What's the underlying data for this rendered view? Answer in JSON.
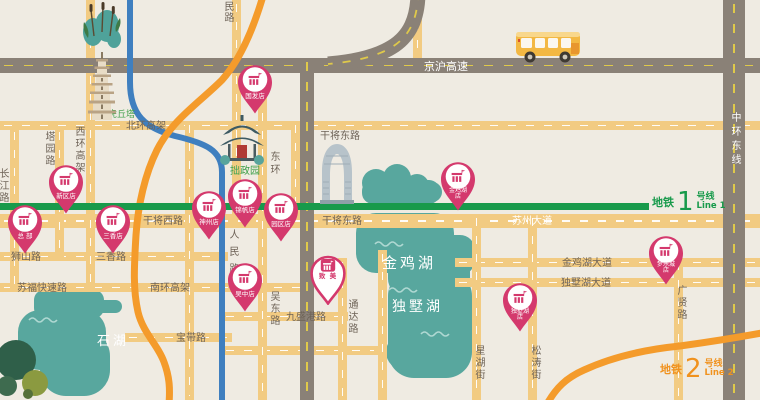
{
  "labels": {
    "jinghu": "京沪高速",
    "zhonghuan": "中环东线",
    "beihuan": "北环高架",
    "ganjiang_east_n": "干将东路",
    "ganjiang_west": "干将西路",
    "ganjiang_east": "干将东路",
    "suzhou_ave": "苏州大道",
    "shishan": "狮山路",
    "sanxiang_rd": "三香路",
    "sufu": "苏福快速路",
    "nanhuan": "南环高架",
    "jiusheng": "九盛港路",
    "baodai": "宝带路",
    "jinjihu_ave": "金鸡湖大道",
    "dushuhu_ave": "独墅湖大道",
    "changjiang": "长江路",
    "tayuan": "塔园路",
    "xihuan": "西环高架",
    "renmin_top": "民路",
    "renmin": "人民路",
    "donghuan": "东环",
    "wudong": "吴东路",
    "tongda": "通达路",
    "xinghu": "星湖街",
    "songtao": "松涛街",
    "guangxian": "广贤路"
  },
  "lakes": {
    "jinji": "金鸡湖",
    "dushu": "独墅湖",
    "shihu": "石湖"
  },
  "landmarks": {
    "huqiu": "虎丘塔",
    "zhuozheng": "拙政园"
  },
  "stores": {
    "guofa": {
      "label": "国发店"
    },
    "xinqu": {
      "label": "新区店"
    },
    "zongbu": {
      "label": "总 部"
    },
    "sanxiang": {
      "label": "三香店"
    },
    "shenzhou": {
      "label": "神州店"
    },
    "jinfan": {
      "label": "锦帆店"
    },
    "yuanqu": {
      "label": "园区店"
    },
    "jinjihu": {
      "line1": "金鸡湖",
      "line2": "店"
    },
    "wuzhong": {
      "label": "吴中店"
    },
    "zhimei": {
      "label": "致 美"
    },
    "menglecheng": {
      "line1": "梦乐城",
      "line2": "店"
    },
    "dushuhu": {
      "line1": "独墅湖",
      "line2": "店"
    }
  },
  "metro": {
    "line1": {
      "cn": "地铁",
      "num": "1",
      "cn2": "号线",
      "en": "Line 1"
    },
    "line2": {
      "cn": "地铁",
      "num": "2",
      "cn2": "号线",
      "en": "Line 2"
    }
  },
  "colors": {
    "line1_green": "#189A4B",
    "line2_orange": "#F49B2B",
    "pin_magenta": "#D4396D",
    "lake_teal": "#58A79E",
    "road_yellow": "#F2CB82",
    "highway_gray": "#8A8177",
    "river_blue": "#3F7FBF",
    "background": "#EFEBE2"
  }
}
